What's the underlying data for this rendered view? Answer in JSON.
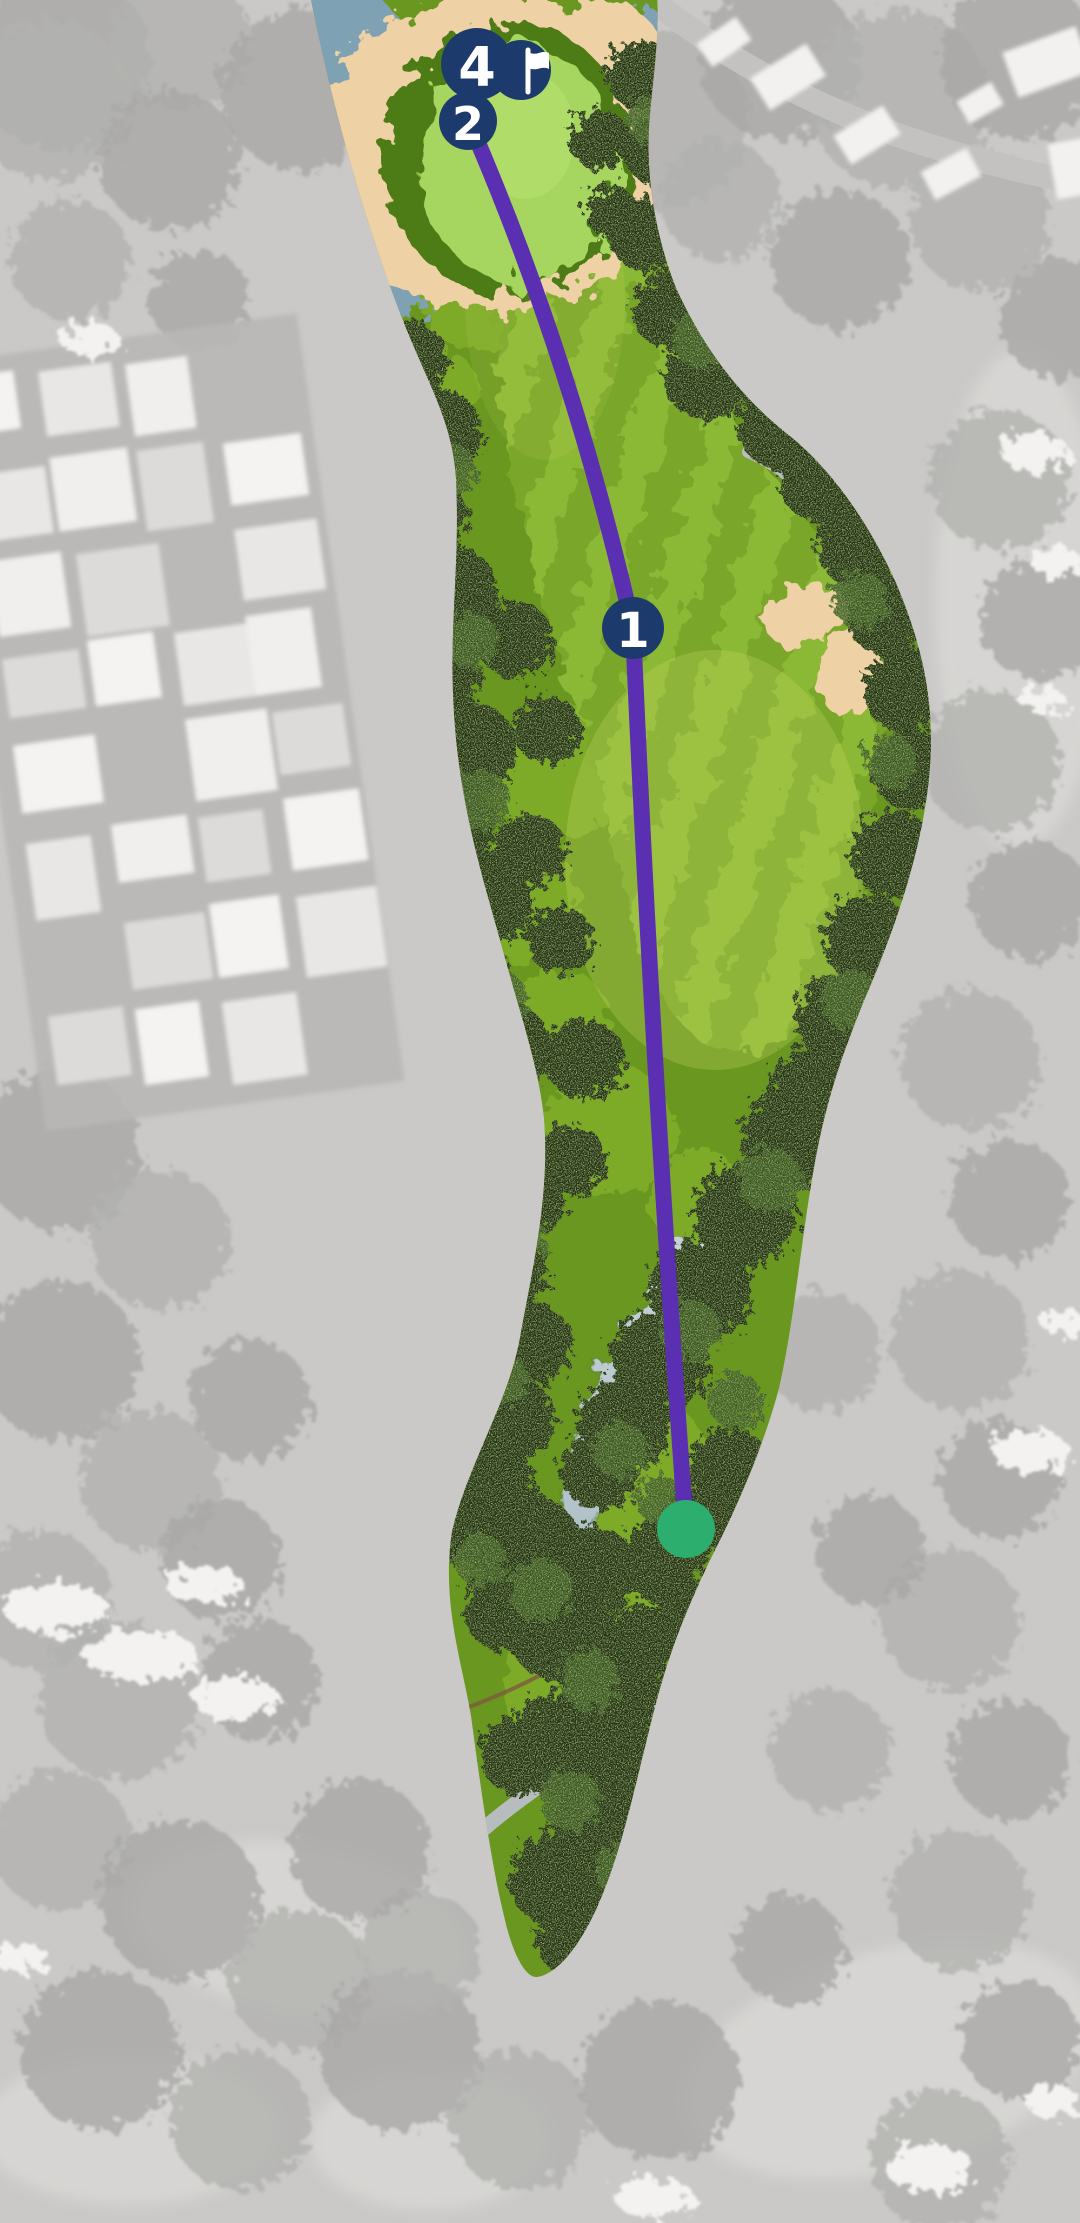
{
  "map": {
    "type": "golf-hole-aerial-shot-tracker",
    "markers": [
      {
        "label": "1",
        "x": 633,
        "y": 628,
        "r": 31
      },
      {
        "label": "2",
        "x": 468,
        "y": 121,
        "r": 29
      },
      {
        "label": "4",
        "x": 477,
        "y": 64,
        "r": 36
      }
    ],
    "pin": {
      "x": 521,
      "y": 70,
      "r": 30,
      "icon": "flag-icon"
    },
    "tee": {
      "x": 686,
      "y": 1529,
      "r": 29
    },
    "shot_path": {
      "d": "M686 1529 Q652 1062 633 628 Q571 355 467 117"
    },
    "colors": {
      "marker_navy": "#1c3b6c",
      "marker_text": "#ffffff",
      "shot_path_purple": "#5a2fb2",
      "tee_green": "#2cae6f",
      "sand": "#eed1a4",
      "water": "#7fa1b4",
      "creek_light": "#ccd8db",
      "fairway_light": "#8cb934",
      "fairway_dark": "#7aa62c",
      "rough_green": "#6a971f",
      "putting_green": "#a6d65e",
      "background_gray": "#cac9c7"
    }
  }
}
